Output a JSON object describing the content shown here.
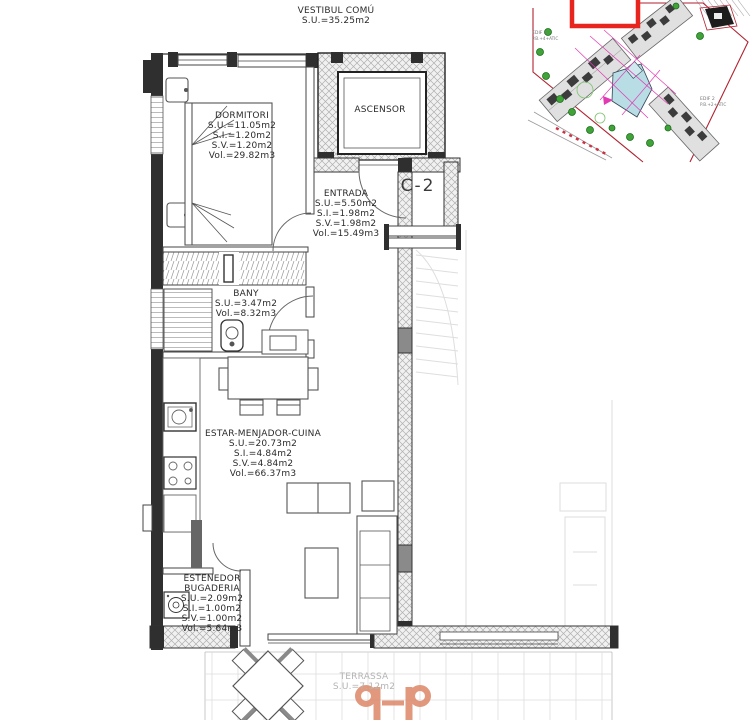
{
  "common_area": {
    "name": "VESTIBUL COMÚ",
    "area": "S.U.=35.25m2"
  },
  "unit_label": "C-2",
  "rooms": {
    "dormitori": {
      "name": "DORMITORI",
      "stats": [
        "S.U.=11.05m2",
        "S.I.=1.20m2",
        "S.V.=1.20m2",
        "Vol.=29.82m3"
      ]
    },
    "ascensor": {
      "name": "ASCENSOR"
    },
    "entrada": {
      "name": "ENTRADA",
      "stats": [
        "S.U.=5.50m2",
        "S.I.=1.98m2",
        "S.V.=1.98m2",
        "Vol.=15.49m3"
      ]
    },
    "bany": {
      "name": "BANY",
      "stats": [
        "S.U.=3.47m2",
        "Vol.=8.32m3"
      ]
    },
    "estar_menjador_cuina": {
      "name": "ESTAR-MENJADOR-CUINA",
      "stats": [
        "S.U.=20.73m2",
        "S.I.=4.84m2",
        "S.V.=4.84m2",
        "Vol.=66.37m3"
      ]
    },
    "estenedor_bugaderia": {
      "name_line1": "ESTENEDOR",
      "name_line2": "BUGADERIA",
      "stats": [
        "S.U.=2.09m2",
        "S.I.=1.00m2",
        "S.V.=1.00m2",
        "Vol.=5.64m3"
      ]
    },
    "terrassa": {
      "name": "TERRASSA",
      "stats": [
        "S.U.=7.12m2"
      ]
    }
  },
  "site_plan": {
    "building_labels": [
      {
        "line1": "EDIF 3",
        "line2": "P.B.+4+ATIC"
      },
      {
        "line1": "EDIF 2",
        "line2": "P.B.+2+ATIC"
      }
    ],
    "highlight_color": "#e8241e",
    "boundary_color": "#b22230",
    "pool_color": "#b8dde4",
    "tree_color": "#3fa337",
    "grid_color": "#e13ab4"
  },
  "watermark": {
    "color": "#dd8a6b"
  },
  "colors": {
    "wall_dark": "#2f2f2f",
    "line": "#555555",
    "terrace_text": "#b4b4b4",
    "faint": "#dddddd"
  }
}
